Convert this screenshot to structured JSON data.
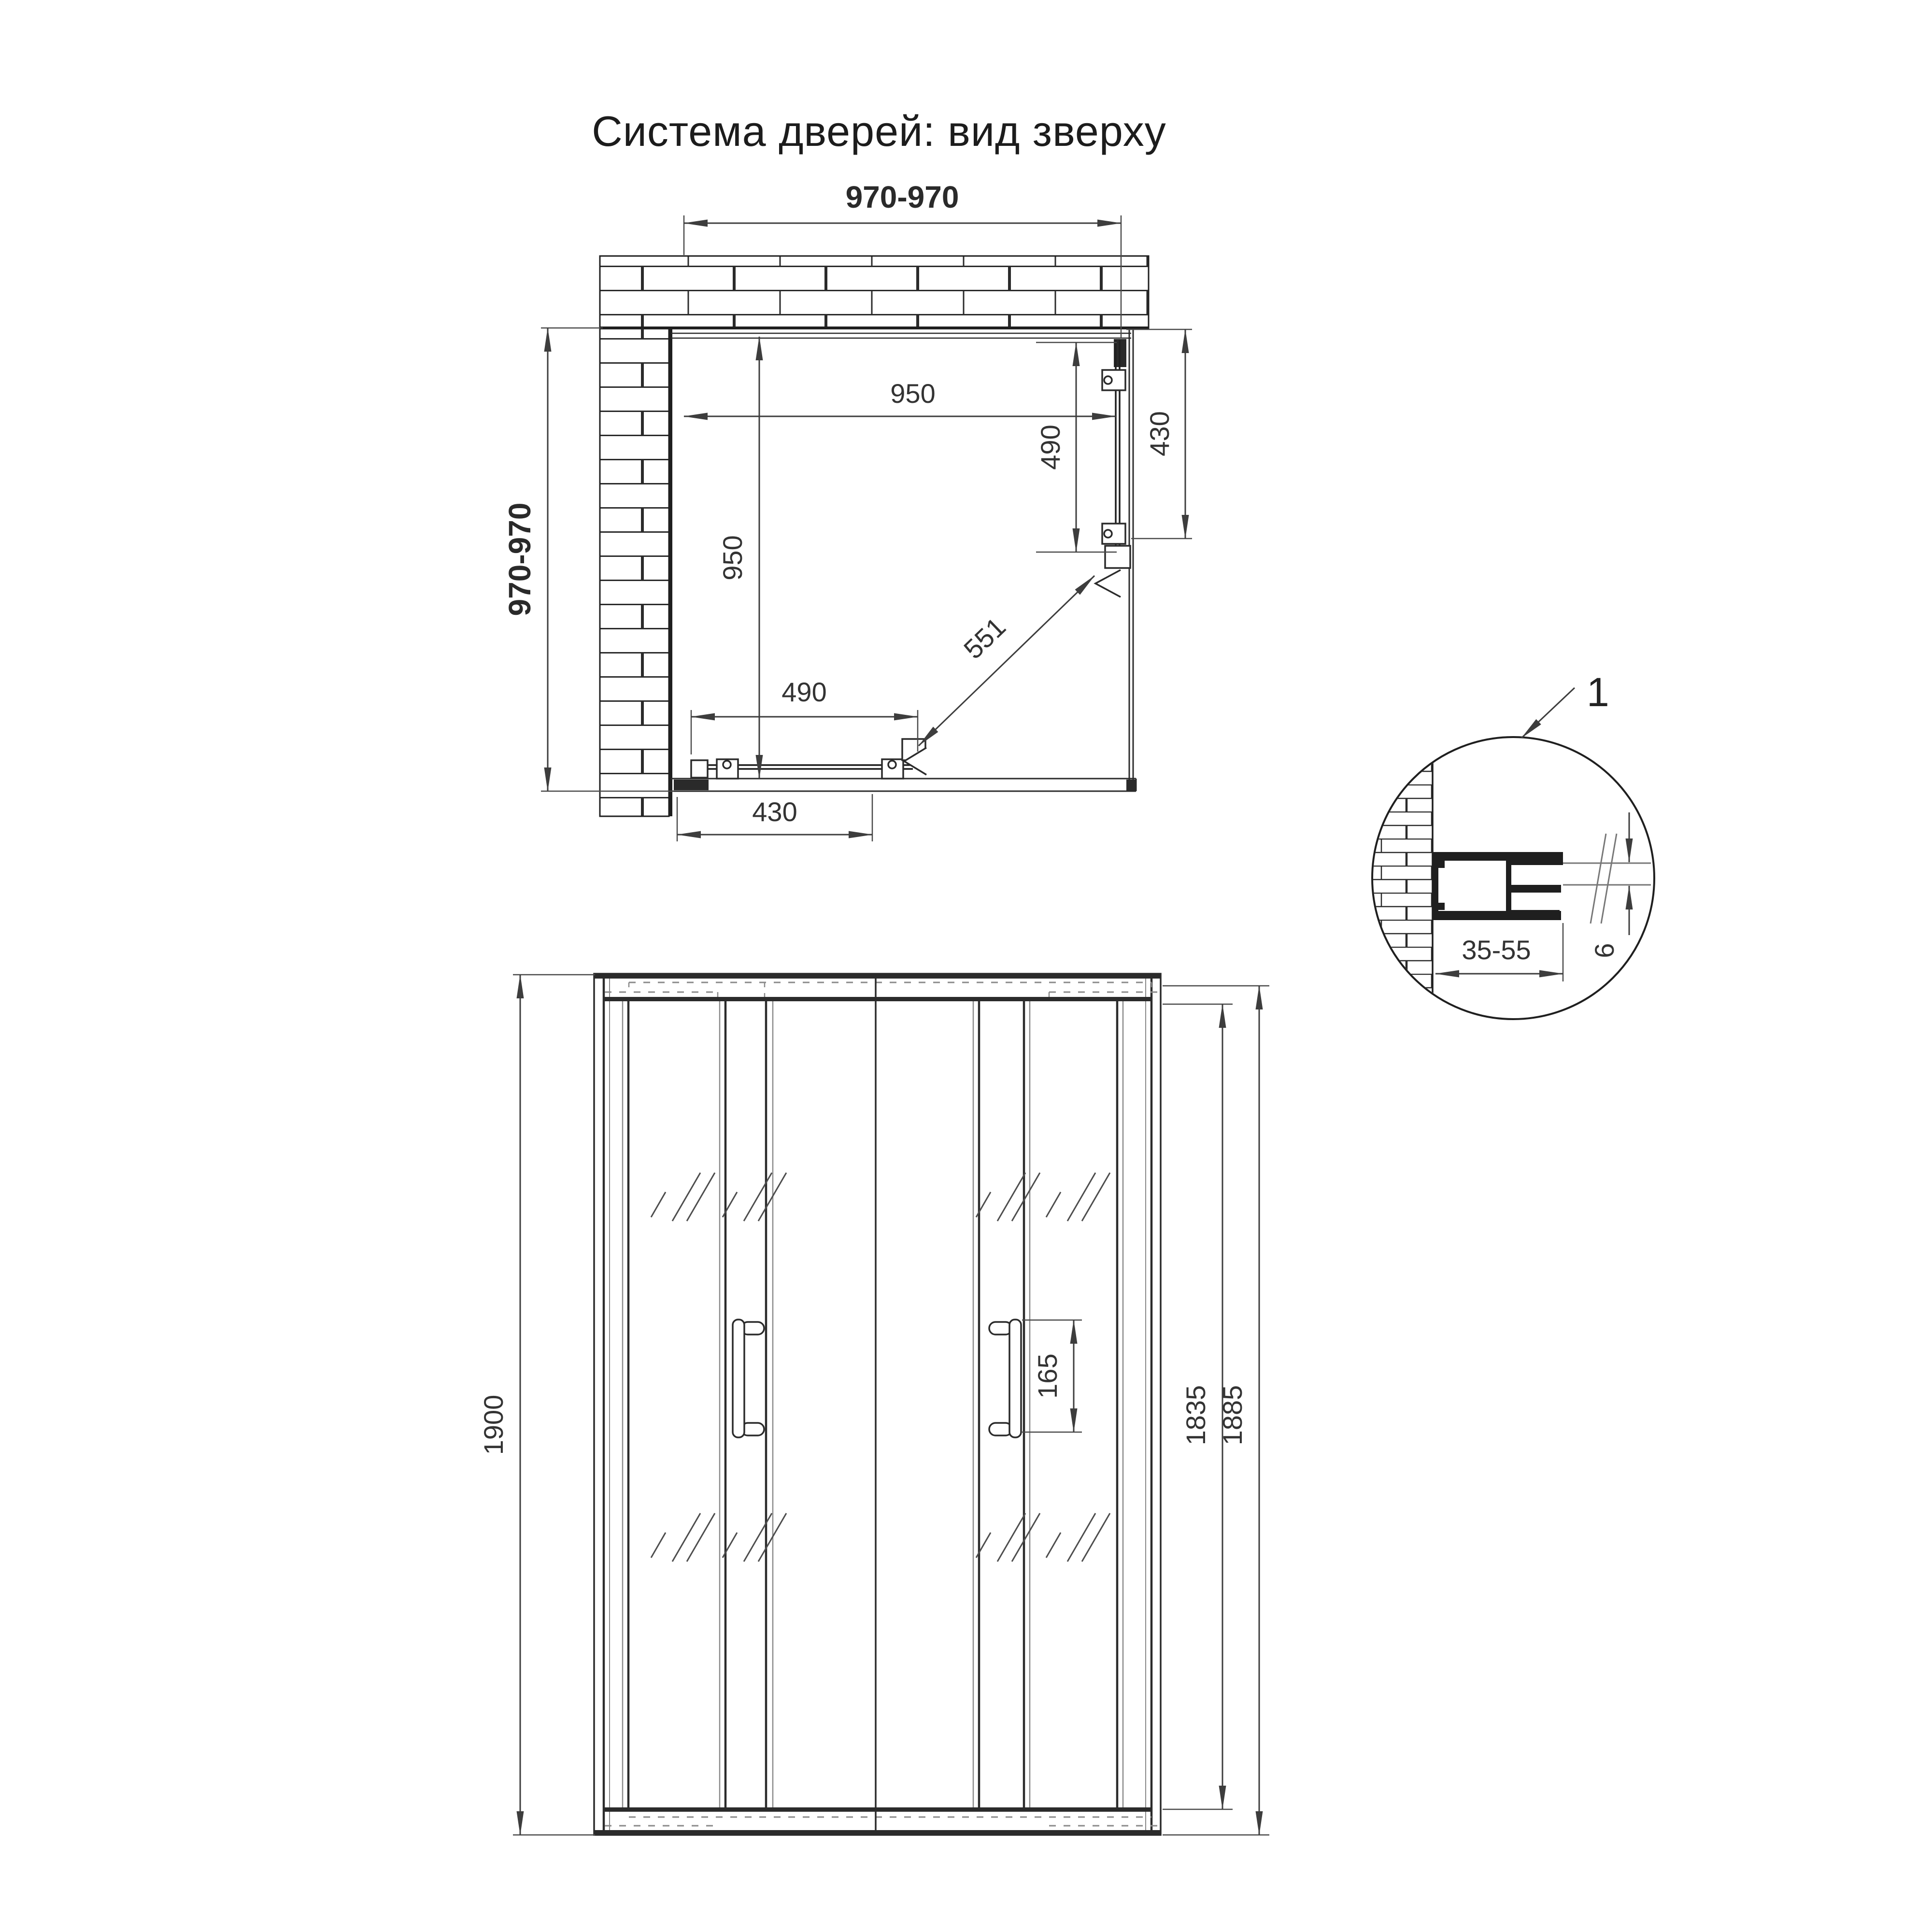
{
  "title": "Система дверей: вид зверху",
  "colors": {
    "ink": "#1f1f1f",
    "dim_line": "#3d3d3d",
    "hidden_line": "#8a8a8a",
    "glass_line": "#777777",
    "background": "#ffffff"
  },
  "plan_view": {
    "dim_width_range": "970-970",
    "dim_depth_range": "970-970",
    "dim_opening_width": "950",
    "dim_opening_depth": "950",
    "dim_side_door_glass": "490",
    "dim_side_door_travel": "430",
    "dim_front_door_glass": "490",
    "dim_front_door_travel": "430",
    "dim_diagonal_entry": "551"
  },
  "detail_view": {
    "callout_number": "1",
    "dim_wall_profile_adjustment": "35-55",
    "dim_glass_thickness": "6"
  },
  "front_view": {
    "dim_total_height": "1900",
    "dim_door_glass_height": "1835",
    "dim_inner_frame_height": "1885",
    "dim_handle_mount_spacing": "165"
  }
}
